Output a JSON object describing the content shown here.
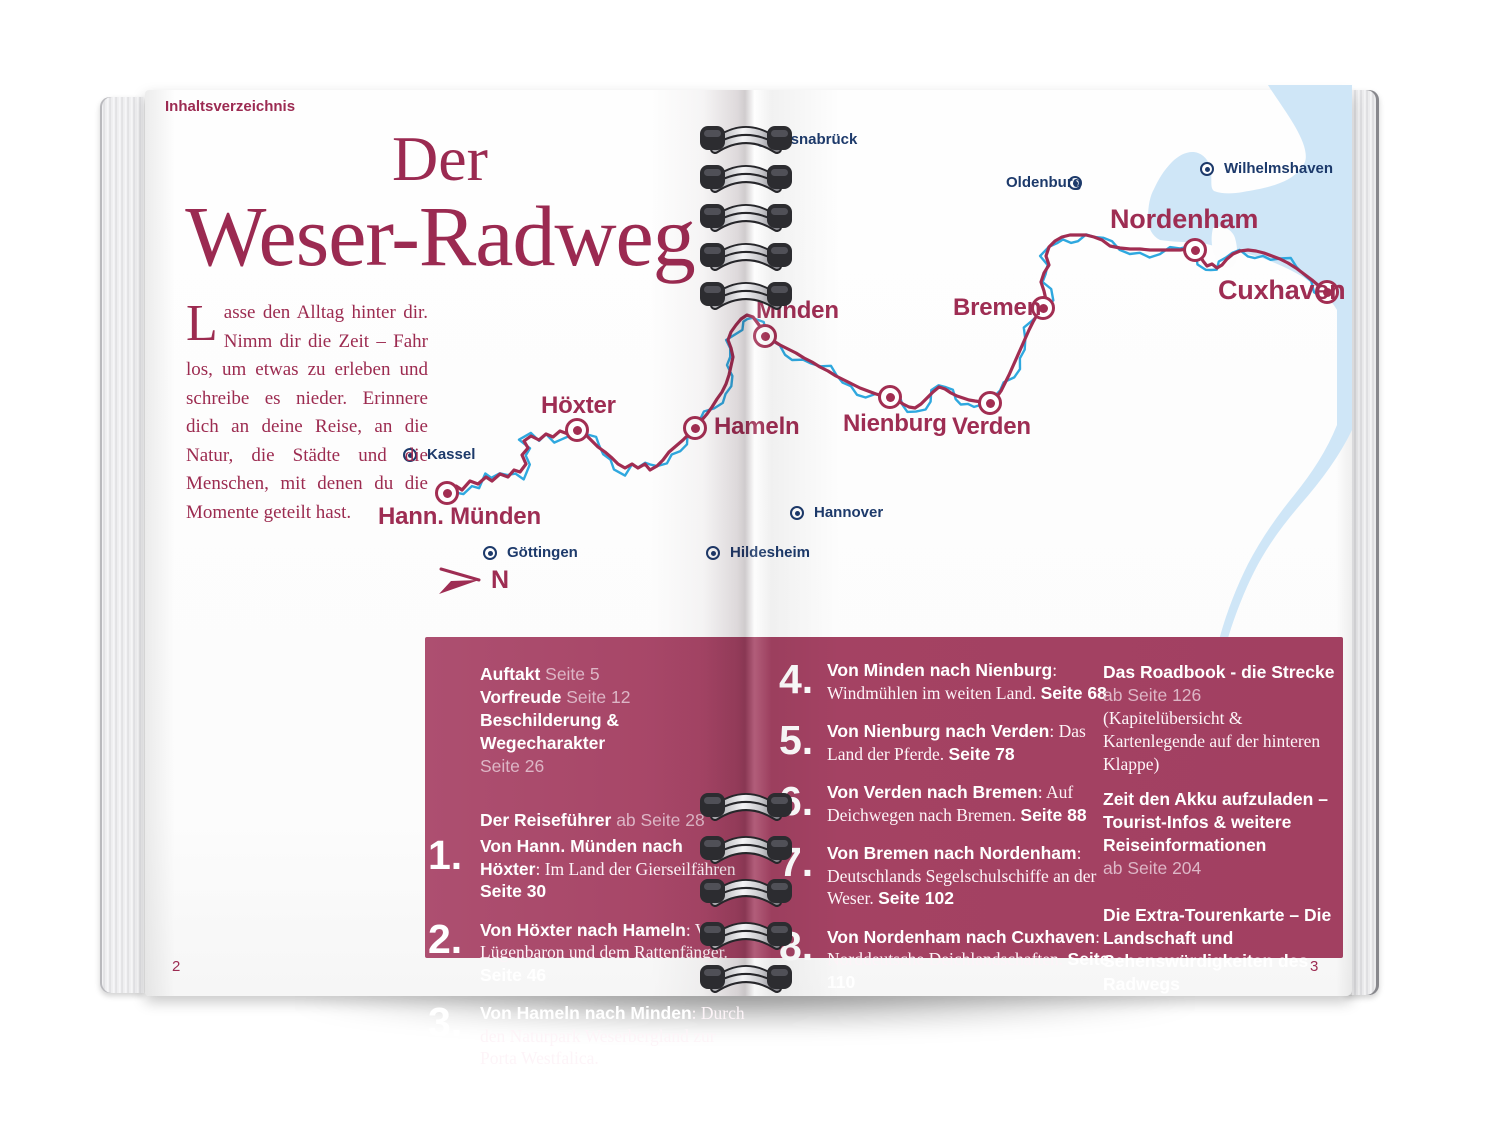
{
  "page": {
    "header_label": "Inhaltsverzeichnis",
    "page_number_left": "2",
    "page_number_right": "3",
    "title": {
      "line1": "Der",
      "line2": "Weser-Radweg"
    },
    "intro": {
      "dropcap": "L",
      "text": "asse den Alltag hinter dir. Nimm dir die Zeit – Fahr los, um etwas zu erleben und schreibe es nieder. Erinnere dich an deine Reise, an die Natur, die Städte und die Menschen, mit denen du die Momente geteilt hast."
    },
    "compass_label": "N"
  },
  "map": {
    "colors": {
      "route": "#a12d52",
      "river": "#2fa8df",
      "water": "#cfe6f7",
      "route_city_label": "#9e2d53",
      "town_label": "#1d3a6b"
    },
    "route_cities": [
      {
        "name": "Hann. Münden",
        "x": 447,
        "y": 493,
        "lx": 378,
        "ly": 503,
        "size": "lg"
      },
      {
        "name": "Höxter",
        "x": 577,
        "y": 430,
        "lx": 541,
        "ly": 392,
        "size": "lg"
      },
      {
        "name": "Hameln",
        "x": 695,
        "y": 428,
        "lx": 714,
        "ly": 413,
        "size": "lg"
      },
      {
        "name": "Minden",
        "x": 765,
        "y": 336,
        "lx": 756,
        "ly": 297,
        "size": "lg"
      },
      {
        "name": "Nienburg",
        "x": 890,
        "y": 397,
        "lx": 843,
        "ly": 410,
        "size": "lg"
      },
      {
        "name": "Verden",
        "x": 990,
        "y": 403,
        "lx": 952,
        "ly": 413,
        "size": "lg"
      },
      {
        "name": "Bremen",
        "x": 1043,
        "y": 308,
        "lx": 953,
        "ly": 294,
        "size": "lg"
      },
      {
        "name": "Nordenham",
        "x": 1195,
        "y": 250,
        "lx": 1110,
        "ly": 204,
        "size": "xl"
      },
      {
        "name": "Cuxhaven",
        "x": 1327,
        "y": 292,
        "lx": 1218,
        "ly": 275,
        "size": "xl"
      }
    ],
    "other_cities": [
      {
        "name": "Kassel",
        "x": 410,
        "y": 455,
        "lx": 427,
        "ly": 446
      },
      {
        "name": "Göttingen",
        "x": 490,
        "y": 553,
        "lx": 507,
        "ly": 544
      },
      {
        "name": "Hildesheim",
        "x": 713,
        "y": 553,
        "lx": 730,
        "ly": 544
      },
      {
        "name": "Hannover",
        "x": 797,
        "y": 513,
        "lx": 814,
        "ly": 504
      },
      {
        "name": "Osnabrück",
        "x": 762,
        "y": 140,
        "lx": 779,
        "ly": 131
      },
      {
        "name": "Oldenburg",
        "x": 1075,
        "y": 183,
        "lx": 1006,
        "ly": 174
      },
      {
        "name": "Wilhelmshaven",
        "x": 1207,
        "y": 169,
        "lx": 1224,
        "ly": 160
      }
    ],
    "route_path": "M447,493 L456,486 L462,490 L470,481 L478,484 L486,477 L492,481 L500,474 L508,477 L514,470 L520,472 L526,464 L522,455 L528,448 L524,441 L531,436 L539,440 L546,434 L553,437 L560,431 L568,434 L577,430 L585,434 L592,441 L598,447 L605,452 L612,458 L618,464 L625,468 L632,464 L638,468 L645,464 L650,470 L657,466 L663,460 L669,452 L676,446 L683,440 L689,434 L695,428 L701,421 L707,414 L712,407 L717,399 L722,392 L726,384 L729,375 L731,366 L733,357 L731,348 L728,340 L731,332 L736,325 L741,319 L747,315 L753,317 L759,325 L765,336 L772,340 L780,345 L788,349 L796,353 L804,358 L812,362 L820,367 L828,371 L836,376 L844,380 L852,384 L860,388 L868,391 L876,394 L883,396 L890,397 L897,400 L903,404 L909,407 L915,408 L921,404 L927,398 L933,392 L939,387 L945,389 L951,393 L957,396 L963,398 L969,400 L975,401 L982,402 L990,403 L996,398 L1001,391 L1005,383 L1009,375 L1013,366 L1017,357 L1021,348 L1025,339 L1029,330 L1033,322 L1037,315 L1043,308 L1046,300 L1044,291 L1041,282 L1044,273 L1049,265 L1046,256 L1049,247 L1055,241 L1062,237 L1070,235 L1078,235 L1086,235 L1094,237 L1102,240 L1110,246 L1120,248 L1130,249 L1140,249 L1150,250 L1160,250 L1170,250 L1180,250 L1188,249 L1195,250 L1200,255 L1203,261 L1207,266 L1212,264 L1217,268 L1222,265 L1227,259 L1233,254 L1240,251 L1248,250 L1256,251 L1264,253 L1272,256 L1280,259 L1288,263 L1296,268 L1304,274 L1312,280 L1319,286 L1327,292",
    "water_main": "M1268,85 L1352,85 L1352,430 C1340,455 1322,480 1300,505 C1282,526 1266,548 1254,572 C1243,594 1233,620 1226,645 L1219,640 C1226,614 1236,588 1248,564 C1261,539 1277,516 1295,494 C1312,473 1327,450 1337,425 L1337,310 C1330,298 1318,287 1303,277 C1288,268 1270,260 1252,255 C1234,250 1217,247 1203,243 C1188,242 1172,242 1160,240 C1152,236 1148,228 1148,218 C1148,206 1150,196 1154,189 C1158,180 1164,170 1172,162 C1180,154 1190,150 1198,153 C1206,156 1210,163 1211,172 C1212,181 1210,188 1214,191 C1222,194 1232,194 1243,192 C1254,190 1268,188 1280,183 C1291,179 1300,172 1305,162 C1309,150 1298,130 1286,112 C1278,100 1271,90 1268,85 Z",
    "water_tail": "M1222,642 C1214,660 1204,676 1192,688 C1184,696 1176,700 1170,702",
    "land_spit": "M1213,228 C1210,240 1212,252 1218,262 C1222,268 1228,270 1233,266 C1238,260 1238,248 1235,238 C1232,229 1222,224 1213,228 Z",
    "coils": {
      "top": [
        137,
        176,
        215,
        254,
        293
      ],
      "bottom": [
        804,
        847,
        890,
        933,
        976
      ]
    }
  },
  "toc": {
    "box_color": "#a24061",
    "intro_items": [
      {
        "label": "Auftakt",
        "page": "Seite 5"
      },
      {
        "label": "Vorfreude",
        "page": "Seite 12"
      },
      {
        "label": "Beschilderung & Wegecharakter",
        "page": "Seite 26",
        "break": true
      }
    ],
    "guide_header": {
      "label": "Der Reiseführer",
      "page": "ab Seite 28"
    },
    "stages_left": [
      {
        "num": "1.",
        "title": "Von Hann. Münden nach Höxter",
        "desc": "Im Land der Gierseilfähren",
        "page": "Seite 30"
      },
      {
        "num": "2.",
        "title": "Von Höxter nach Hameln",
        "desc": "Vom Lügenbaron und dem Rattenfänger.",
        "page": "Seite 46"
      },
      {
        "num": "3.",
        "title": "Von Hameln nach Minden",
        "desc": "Durch den Naturpark Weserbergland zur Porta Westfalica.",
        "page": "Seite 56"
      }
    ],
    "stages_right": [
      {
        "num": "4.",
        "title": "Von Minden nach Nienburg",
        "desc": "Windmühlen im weiten Land.",
        "page": "Seite 68"
      },
      {
        "num": "5.",
        "title": "Von Nienburg nach Verden",
        "desc": "Das Land der Pferde.",
        "page": "Seite 78"
      },
      {
        "num": "6.",
        "title": "Von Verden nach Bremen",
        "desc": "Auf Deichwegen nach Bremen.",
        "page": "Seite 88"
      },
      {
        "num": "7.",
        "title": "Von Bremen nach Nordenham",
        "desc": "Deutschlands Segelschulschiffe an der Weser.",
        "page": "Seite 102"
      },
      {
        "num": "8.",
        "title": "Von Nordenham nach Cuxha­ven",
        "desc": "Norddeutsche Deichlandschaften.",
        "page": "Seite 110"
      }
    ],
    "extras": [
      {
        "title": "Das Roadbook - die Strecke",
        "page": "ab Seite 126",
        "note": "(Kapitelübersicht & Kartenlegende auf der hinteren Klappe)"
      },
      {
        "title": "Zeit den Akku aufzuladen – Tourist-Infos & weitere Reiseinformationen",
        "page": "ab Seite 204"
      },
      {
        "title": "Die Extra-Tourenkarte – Die Land­schaft und Sehenswürdigkeiten des Radwegs",
        "gap": true
      }
    ]
  }
}
